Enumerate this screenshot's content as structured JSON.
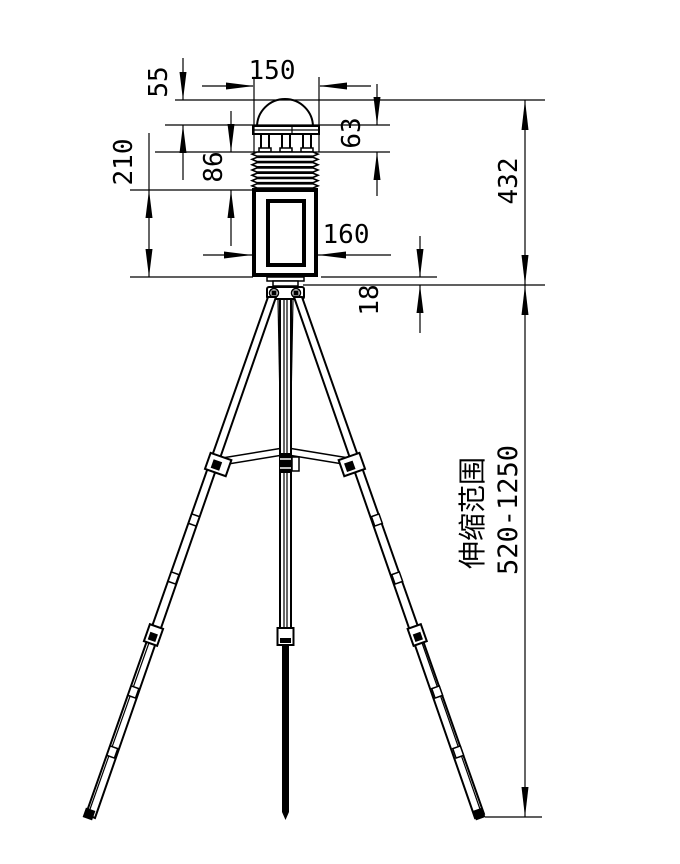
{
  "drawing": {
    "type": "technical-dimension-drawing",
    "subject": "weather-station sensor on telescoping tripod",
    "background": "#ffffff",
    "line_color": "#000000",
    "dimensions": {
      "cap_width": "150",
      "dome_height": "55",
      "cap_stack_height": "63",
      "shield_height": "86",
      "body_height": "210",
      "body_width": "160",
      "mount_height": "18",
      "head_total_height": "432",
      "tripod_range_label": "伸缩范围",
      "tripod_range_value": "520-1250"
    }
  }
}
